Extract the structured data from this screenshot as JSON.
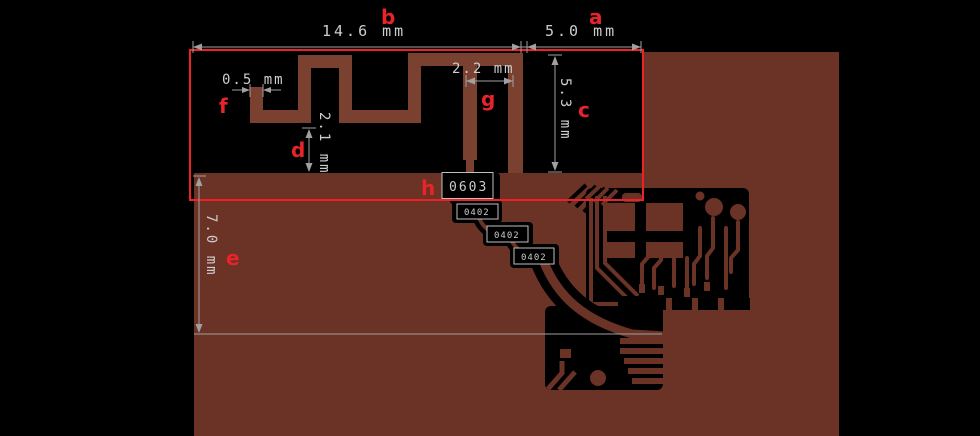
{
  "colors": {
    "background": "#000000",
    "copper_pour": "#6a3326",
    "antenna_trace": "#7a4030",
    "keepout_outline": "#ee2127",
    "dimension_lines": "#a0a0a0",
    "dimension_text": "#cdcdcd",
    "label_red": "#e8242a",
    "component_box_border": "#c0c0c0"
  },
  "dimensions": {
    "a": {
      "label": "a",
      "value": "5.0 mm"
    },
    "b": {
      "label": "b",
      "value": "14.6 mm"
    },
    "c": {
      "label": "c",
      "value": "5.3 mm"
    },
    "d": {
      "label": "d",
      "value": "2.1 mm"
    },
    "e": {
      "label": "e",
      "value": "7.0 mm"
    },
    "f": {
      "label": "f",
      "value": "0.5 mm"
    },
    "g": {
      "label": "g",
      "value": "2.2 mm"
    },
    "h": {
      "label": "h"
    }
  },
  "components": {
    "c0603": {
      "label": "0603"
    },
    "c0402_top": {
      "label": "0402"
    },
    "c0402_mid": {
      "label": "0402"
    },
    "c0402_bottom": {
      "label": "0402"
    }
  }
}
